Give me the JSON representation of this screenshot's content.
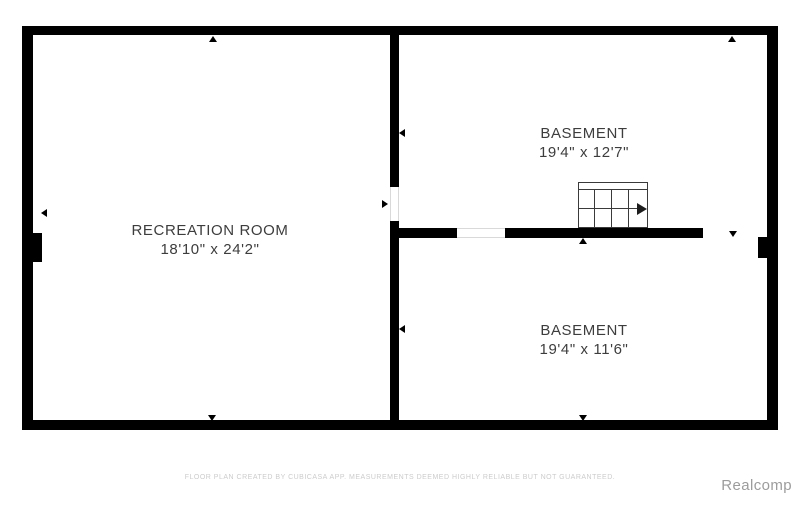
{
  "plan": {
    "rooms": [
      {
        "name": "RECREATION ROOM",
        "dims": "18'10\" x 24'2\""
      },
      {
        "name": "BASEMENT",
        "dims": "19'4\" x 12'7\""
      },
      {
        "name": "BASEMENT",
        "dims": "19'4\" x 11'6\""
      }
    ]
  },
  "footer": {
    "disclaimer": "FLOOR PLAN CREATED BY CUBICASA APP. MEASUREMENTS DEEMED HIGHLY RELIABLE BUT NOT GUARANTEED.",
    "watermark": "Realcomp"
  },
  "colors": {
    "wall": "#000000",
    "label": "#3d3d3d",
    "disclaimer": "#cccccc",
    "watermark": "#9c9c9c"
  }
}
